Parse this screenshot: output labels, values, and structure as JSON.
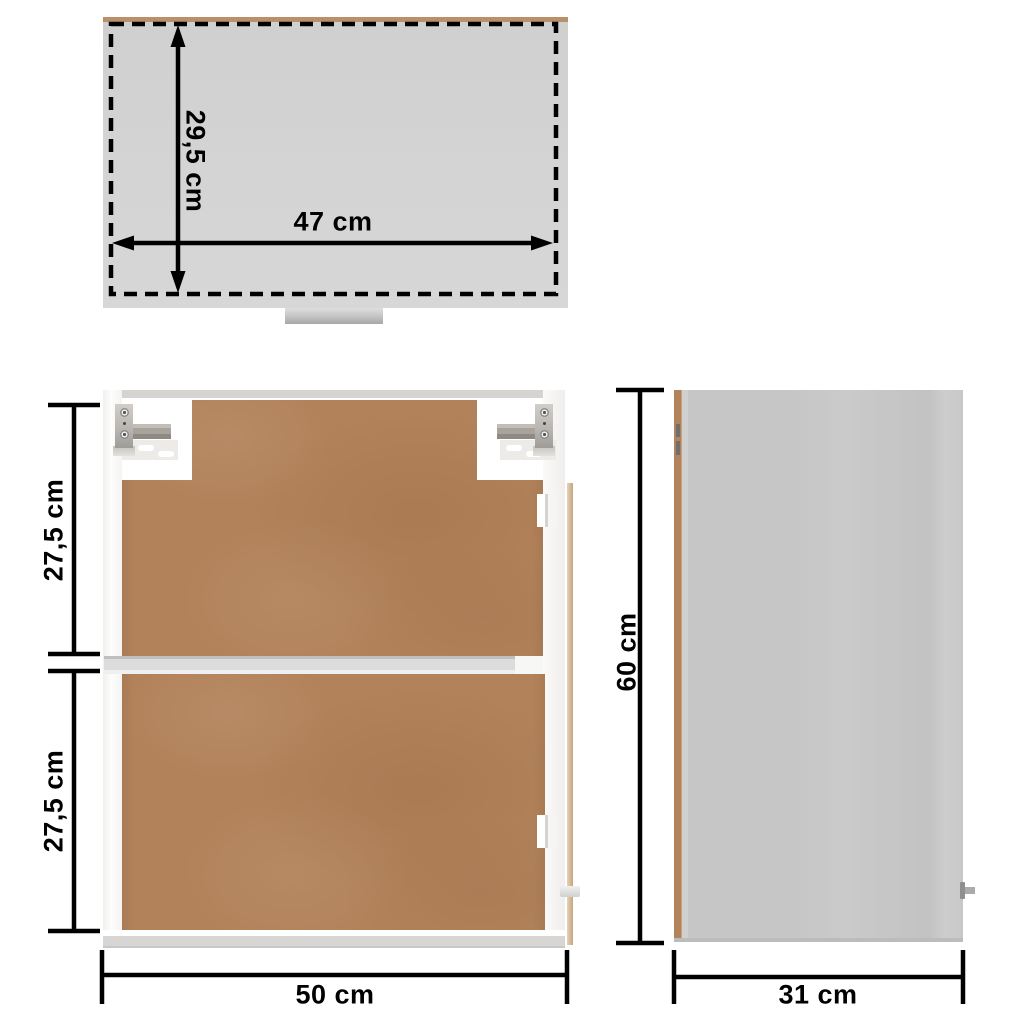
{
  "diagram": {
    "views": {
      "top": {
        "depth_label": "29,5 cm",
        "width_label": "47 cm"
      },
      "front": {
        "upper_section_label": "27,5 cm",
        "lower_section_label": "27,5 cm",
        "width_label": "50 cm"
      },
      "side": {
        "height_label": "60 cm",
        "depth_label": "31 cm"
      }
    },
    "colors": {
      "dimension_ink": "#000000",
      "top_view_fill": "#d3d3d3",
      "wood_edge": "#b9906a",
      "mdf_panel": "#b2825a",
      "frame_white": "#fcfcfb",
      "side_panel_gray": "#c8c8c8",
      "background": "#ffffff"
    }
  }
}
